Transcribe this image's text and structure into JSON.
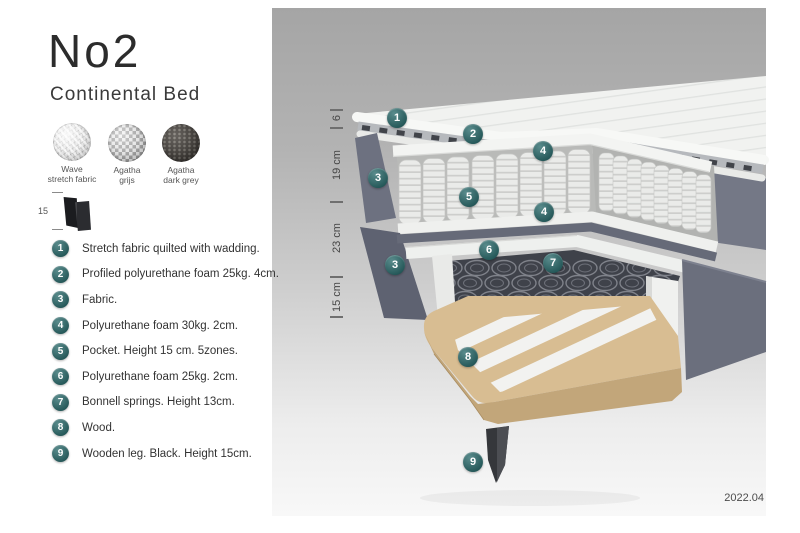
{
  "product": {
    "title": "No2",
    "subtitle": "Continental Bed",
    "version": "2022.04"
  },
  "swatches": [
    {
      "name": "wave-stretch-fabric",
      "line1": "Wave",
      "line2": "stretch fabric"
    },
    {
      "name": "agatha-grijs",
      "line1": "Agatha",
      "line2": "grijs"
    },
    {
      "name": "agatha-dark-grey",
      "line1": "Agatha",
      "line2": "dark grey"
    }
  ],
  "leg_figure": {
    "height_label": "15"
  },
  "legend": {
    "items": [
      {
        "number": "1",
        "text": "Stretch fabric quilted with wadding."
      },
      {
        "number": "2",
        "text": "Profiled polyurethane foam 25kg. 4cm."
      },
      {
        "number": "3",
        "text": "Fabric."
      },
      {
        "number": "4",
        "text": "Polyurethane foam 30kg. 2cm."
      },
      {
        "number": "5",
        "text": "Pocket. Height 15 cm. 5zones."
      },
      {
        "number": "6",
        "text": "Polyurethane foam 25kg. 2cm."
      },
      {
        "number": "7",
        "text": "Bonnell springs. Height 13cm."
      },
      {
        "number": "8",
        "text": "Wood."
      },
      {
        "number": "9",
        "text": "Wooden leg. Black. Height 15cm."
      }
    ]
  },
  "diagram": {
    "measurements": [
      {
        "label": "6"
      },
      {
        "label": "19 cm"
      },
      {
        "label": "23 cm"
      },
      {
        "label": "15 cm"
      }
    ],
    "callouts": [
      {
        "number": "1"
      },
      {
        "number": "2"
      },
      {
        "number": "4"
      },
      {
        "number": "3"
      },
      {
        "number": "5"
      },
      {
        "number": "4"
      },
      {
        "number": "6"
      },
      {
        "number": "3"
      },
      {
        "number": "7"
      },
      {
        "number": "8"
      },
      {
        "number": "9"
      }
    ]
  },
  "colors": {
    "accent_teal": "#2b6b6c",
    "stage_grey_top": "#a5a5a5",
    "mattress_white": "#f1f2f0",
    "fabric_grey": "#6b6f7d",
    "wood": "#d8bd92",
    "leg_black": "#35373b"
  }
}
